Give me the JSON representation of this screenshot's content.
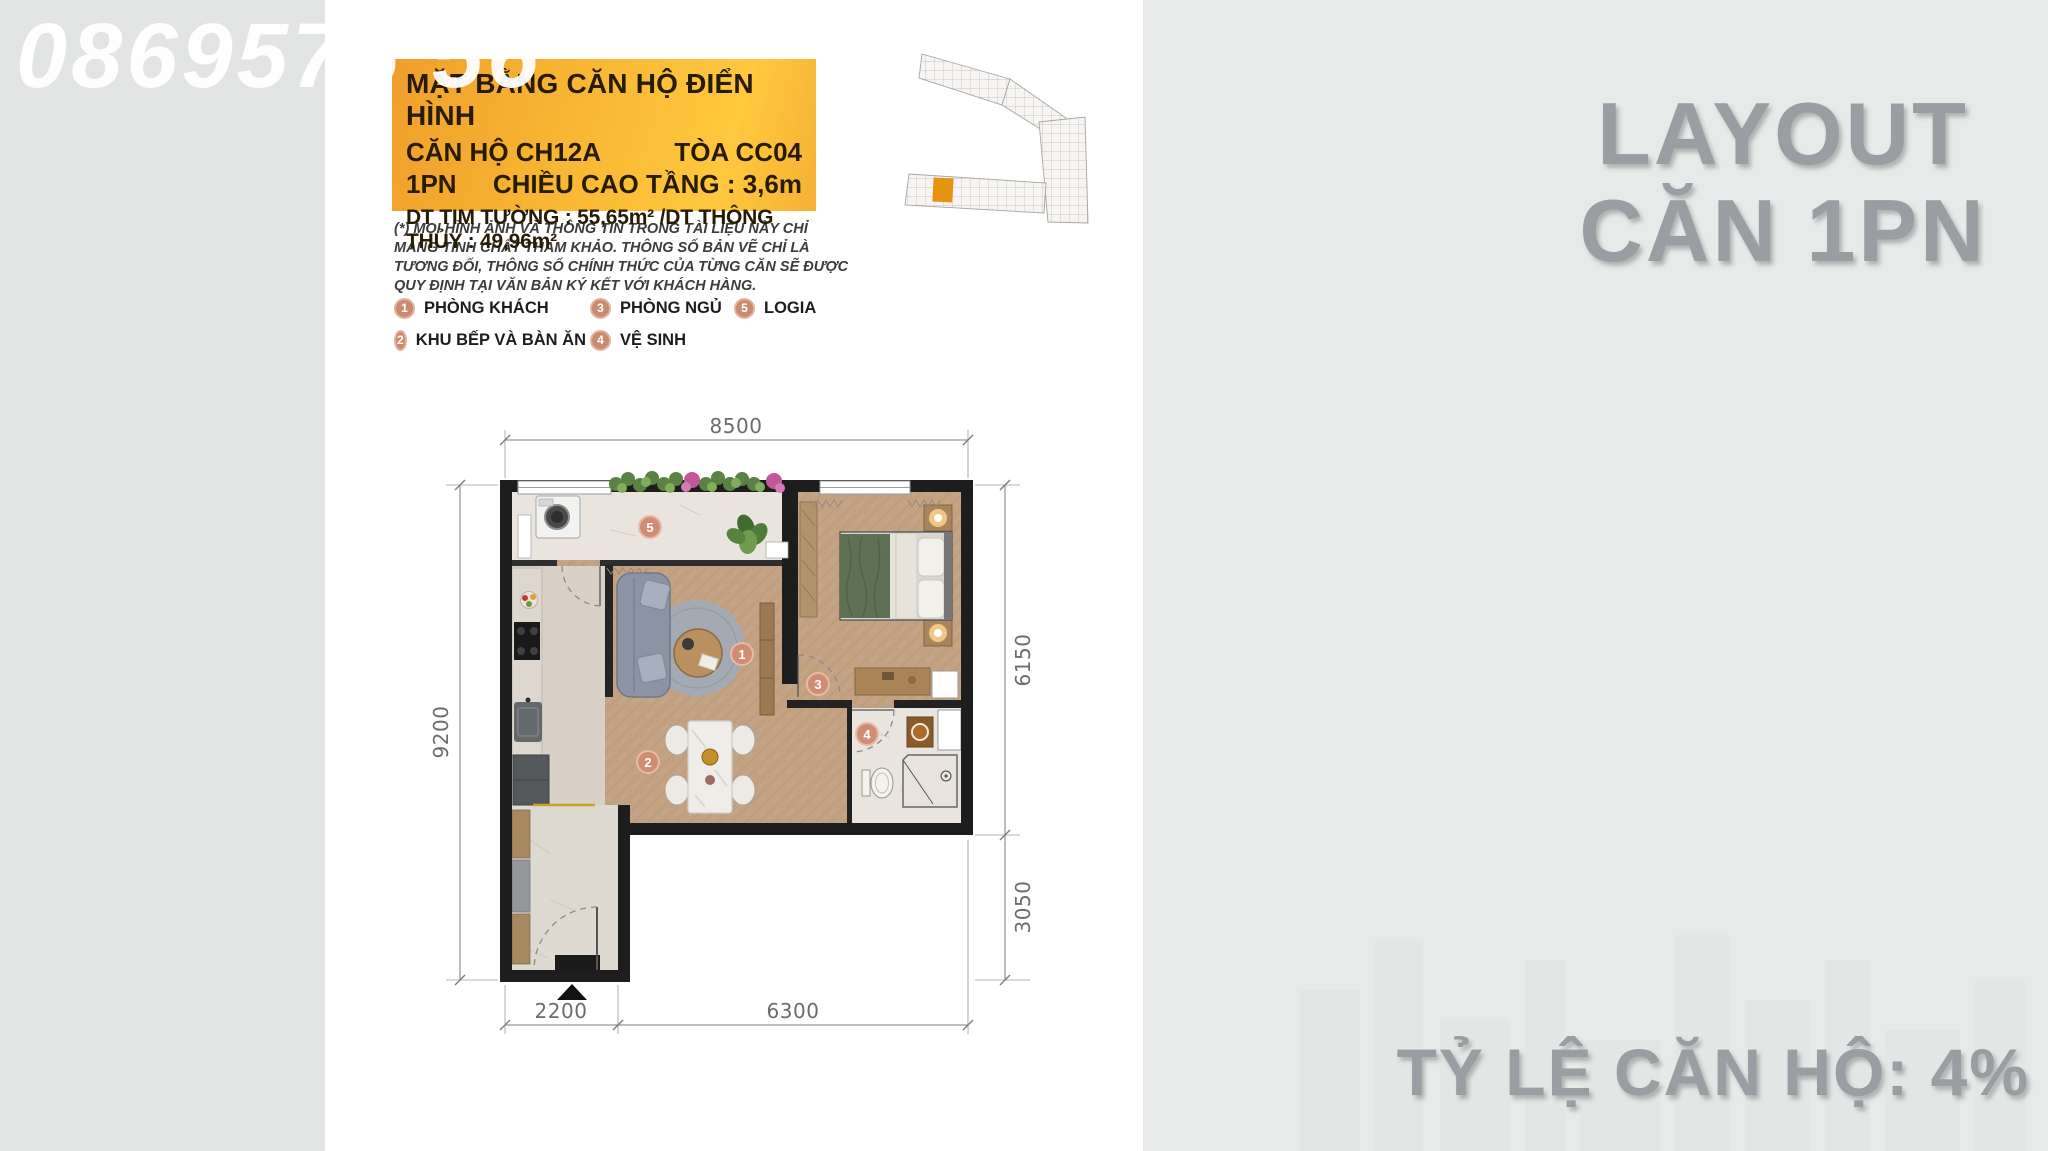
{
  "watermark": {
    "part1": "0869576",
    "part2": "56"
  },
  "info_box": {
    "title": "MẶT BẰNG CĂN HỘ ĐIỂN HÌNH",
    "unit_label": "CĂN HỘ CH12A",
    "tower_label": "TÒA CC04",
    "type_label": "1PN",
    "height_label": "CHIỀU CAO TẦNG : 3,6m",
    "area_label": "DT TIM TƯỜNG : 55,65m² /DT THÔNG THỦY : 49,96m²"
  },
  "disclaimer": "(*) MỌI HÌNH ẢNH VÀ THÔNG TIN TRONG TÀI LIỆU NÀY CHỈ MANG TÍNH CHẤT THAM KHẢO. THÔNG SỐ BẢN VẼ CHỈ LÀ TƯƠNG ĐỐI, THÔNG SỐ CHÍNH THỨC CỦA TỪNG CĂN SẼ ĐƯỢC QUY ĐỊNH TẠI VĂN BẢN KÝ KẾT VỚI KHÁCH HÀNG.",
  "legend": {
    "items": [
      {
        "num": "1",
        "label": "PHÒNG KHÁCH"
      },
      {
        "num": "2",
        "label": "KHU BẾP VÀ BÀN ĂN"
      },
      {
        "num": "3",
        "label": "PHÒNG NGỦ"
      },
      {
        "num": "4",
        "label": "VỆ SINH"
      },
      {
        "num": "5",
        "label": "LOGIA"
      }
    ]
  },
  "side_title": {
    "line1": "LAYOUT",
    "line2": "CĂN 1PN"
  },
  "footer": {
    "ratio_text": "TỶ LỆ CĂN HỘ: 4%"
  },
  "floor_plan": {
    "dimensions": {
      "top": "8500",
      "left": "9200",
      "right_upper": "6150",
      "right_lower": "3050",
      "bottom_left": "2200",
      "bottom_right": "6300"
    }
  },
  "colors": {
    "accent_yellow": "#f7b432",
    "badge": "#cb8a70",
    "title_gray": "#9a9da1",
    "wall": "#1d1d1d",
    "highlight_unit": "#e8930f"
  }
}
